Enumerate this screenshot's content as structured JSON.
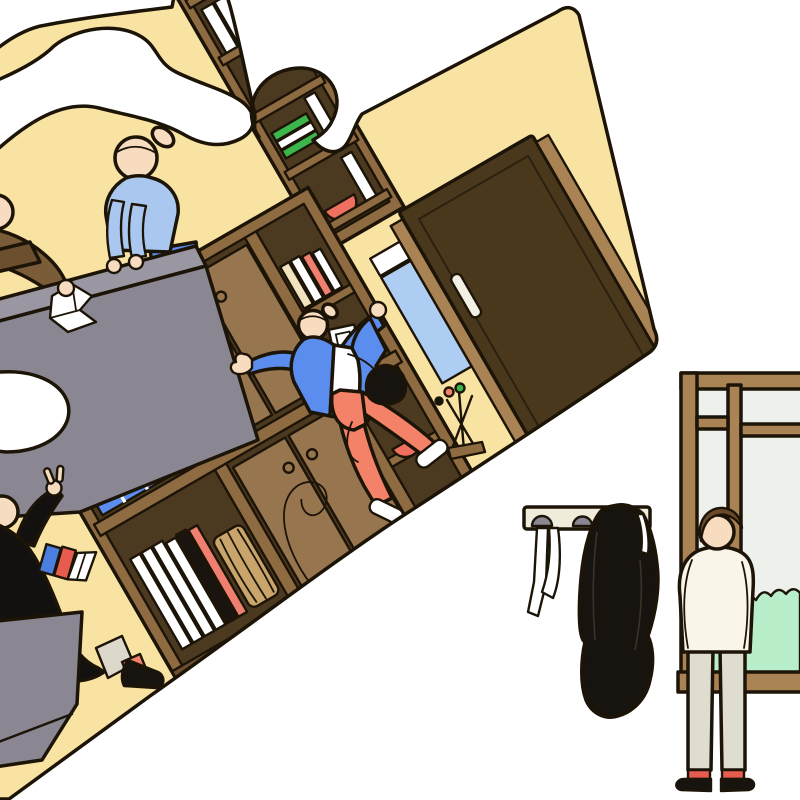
{
  "illustration": {
    "description": "Flat editorial illustration: a large tilted jigsaw-puzzle piece contains a cozy yellow office-library scene with bookshelves, a desk and four people, while outside the piece a man stands with hands in pockets looking out a brown-framed window beside a wall coat rack holding a black coat and a white scarf.",
    "background": "#ffffff"
  },
  "palette": {
    "cream_wall": "#f8e3a3",
    "outline": "#1d1408",
    "white": "#ffffff",
    "brown_frame": "#8f6b42",
    "brown_dark_interior": "#4c3a20",
    "brown_door": "#4a381c",
    "brown_panel": "#97764f",
    "tan_jamb": "#a98354",
    "brown_plinth": "#6b4f2e",
    "brown_sweater": "#7a5c38",
    "book_blue": "#4a7fe0",
    "jacket_blue": "#5b8def",
    "sweater_light_blue": "#a9c7ef",
    "pants_blue": "#5c8cec",
    "glass_blue": "#aecdf2",
    "book_salmon": "#ef8070",
    "pants_salmon": "#f48268",
    "sock_red": "#e85c50",
    "bowl_red": "#f07060",
    "book_green": "#3cb54a",
    "hedge_mint": "#b9eecb",
    "desk_gray": "#8a8793",
    "desk_slab_gray": "#9a97a3",
    "cuff_gray": "#dcd8cc",
    "sky_gray": "#eef0ec",
    "rack_cream": "#f0ecdc",
    "skin": "#f7dcc0",
    "shirt_white": "#faf5e9",
    "pants_beige": "#dfdcd0",
    "hair_brown": "#6b4a2a",
    "coat_black": "#17130e",
    "robe_black": "#131110",
    "basket_tan": "#c9a56b",
    "book_cream": "#f2e3c0"
  },
  "puzzle_scene": {
    "tilt_degrees": -30,
    "elements": [
      {
        "name": "tall-bookcase",
        "contents": "blue, white, red and green books, red bowl"
      },
      {
        "name": "wall-shelf-unit",
        "contents": "cabinet doors with round knobs, white and black book spines, blue grid boxes, wicker basket, red bowls, green books, picture frame, cord loop"
      },
      {
        "name": "gray-desk",
        "contents": "crumpled white paper"
      },
      {
        "name": "woman-leaning-on-desk",
        "outfit": "light blue sweater, blue pants, hair bun"
      },
      {
        "name": "coworker-at-left-edge",
        "outfit": "brown sweater"
      },
      {
        "name": "person-in-black-gown",
        "holding": "blue book, red book, white papers",
        "gesture": "raised hand with V fingers",
        "outfit": "black gown, gray cuff, salmon sock, black shoe"
      },
      {
        "name": "dancing-person",
        "outfit": "blue jacket, white shirt, salmon pants, white sneakers, black shoulder bag, hair bun"
      },
      {
        "name": "wooden-door",
        "details": "dark brown door, tan jambs, white vertical handle, blue glass sidelight"
      },
      {
        "name": "umbrella-stand",
        "details": "crossed wooden stand, salmon and green umbrella tips"
      },
      {
        "name": "gray-cabinet",
        "details": "low rolling cabinet"
      }
    ],
    "cutouts": [
      "white bay blob near top-left",
      "white socket notch on left edge",
      "knob tab beside tall bookcase"
    ]
  },
  "window_scene": {
    "elements": [
      {
        "name": "coat-rack",
        "details": "cream wall bar, two gray dome hooks, white scarf, black coat"
      },
      {
        "name": "man-at-window",
        "outfit": "off-white shirt, beige trousers, red socks, black shoes",
        "pose": "hands in pockets, balding, looking out"
      },
      {
        "name": "window",
        "details": "brown frame with mullion and transoms, pale sky, mint green hedge"
      }
    ]
  }
}
